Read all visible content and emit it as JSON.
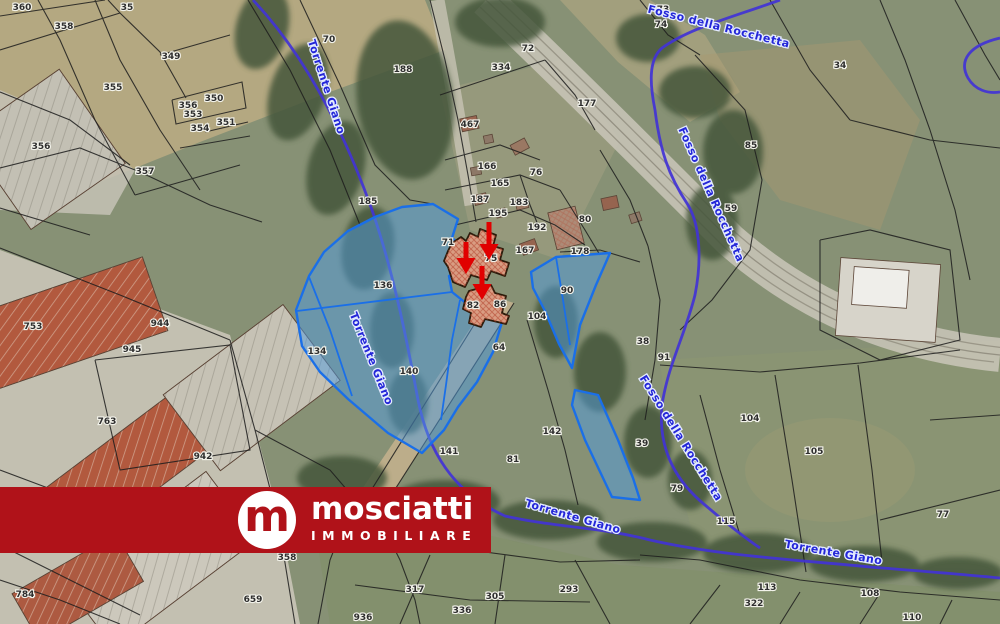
{
  "logo": {
    "monogram": "m",
    "name": "mosciatti",
    "subtitle": "IMMOBILIARE"
  },
  "colors": {
    "banner_red": "#b01219",
    "highlight_fill": "#4f9be0",
    "highlight_stroke": "#1a6fe8",
    "stream_blue": "#4233d6",
    "stream_label_blue": "#2326d8",
    "arrow_red": "#e10000",
    "cadastral_line": "#1d1d1d"
  },
  "map": {
    "parcel_labels": [
      {
        "t": "360",
        "x": 22,
        "y": 10
      },
      {
        "t": "35",
        "x": 127,
        "y": 10
      },
      {
        "t": "358",
        "x": 64,
        "y": 29
      },
      {
        "t": "349",
        "x": 171,
        "y": 59
      },
      {
        "t": "355",
        "x": 113,
        "y": 90
      },
      {
        "t": "356",
        "x": 188,
        "y": 108
      },
      {
        "t": "353",
        "x": 193,
        "y": 117
      },
      {
        "t": "350",
        "x": 214,
        "y": 101
      },
      {
        "t": "354",
        "x": 200,
        "y": 131
      },
      {
        "t": "351",
        "x": 226,
        "y": 125
      },
      {
        "t": "357",
        "x": 145,
        "y": 174
      },
      {
        "t": "356",
        "x": 41,
        "y": 149
      },
      {
        "t": "70",
        "x": 329,
        "y": 42
      },
      {
        "t": "188",
        "x": 403,
        "y": 72
      },
      {
        "t": "185",
        "x": 368,
        "y": 204
      },
      {
        "t": "467",
        "x": 470,
        "y": 127
      },
      {
        "t": "334",
        "x": 501,
        "y": 70
      },
      {
        "t": "72",
        "x": 528,
        "y": 51
      },
      {
        "t": "177",
        "x": 587,
        "y": 106
      },
      {
        "t": "73",
        "x": 663,
        "y": 12
      },
      {
        "t": "74",
        "x": 661,
        "y": 27
      },
      {
        "t": "34",
        "x": 840,
        "y": 68
      },
      {
        "t": "85",
        "x": 751,
        "y": 148
      },
      {
        "t": "59",
        "x": 731,
        "y": 211
      },
      {
        "t": "166",
        "x": 487,
        "y": 169
      },
      {
        "t": "165",
        "x": 500,
        "y": 186
      },
      {
        "t": "187",
        "x": 480,
        "y": 202
      },
      {
        "t": "183",
        "x": 519,
        "y": 205
      },
      {
        "t": "195",
        "x": 498,
        "y": 216
      },
      {
        "t": "76",
        "x": 536,
        "y": 175
      },
      {
        "t": "192",
        "x": 537,
        "y": 230
      },
      {
        "t": "80",
        "x": 585,
        "y": 222
      },
      {
        "t": "178",
        "x": 580,
        "y": 254
      },
      {
        "t": "167",
        "x": 525,
        "y": 253
      },
      {
        "t": "71",
        "x": 448,
        "y": 245
      },
      {
        "t": "75",
        "x": 491,
        "y": 261
      },
      {
        "t": "82",
        "x": 473,
        "y": 308
      },
      {
        "t": "86",
        "x": 500,
        "y": 307
      },
      {
        "t": "90",
        "x": 567,
        "y": 293
      },
      {
        "t": "104",
        "x": 537,
        "y": 319
      },
      {
        "t": "38",
        "x": 643,
        "y": 344
      },
      {
        "t": "91",
        "x": 664,
        "y": 360
      },
      {
        "t": "136",
        "x": 383,
        "y": 288
      },
      {
        "t": "134",
        "x": 317,
        "y": 354
      },
      {
        "t": "140",
        "x": 409,
        "y": 374
      },
      {
        "t": "64",
        "x": 499,
        "y": 350
      },
      {
        "t": "753",
        "x": 33,
        "y": 329
      },
      {
        "t": "944",
        "x": 160,
        "y": 326
      },
      {
        "t": "945",
        "x": 132,
        "y": 352
      },
      {
        "t": "763",
        "x": 107,
        "y": 424
      },
      {
        "t": "942",
        "x": 203,
        "y": 459
      },
      {
        "t": "784",
        "x": 25,
        "y": 597
      },
      {
        "t": "659",
        "x": 253,
        "y": 602
      },
      {
        "t": "358",
        "x": 287,
        "y": 560
      },
      {
        "t": "141",
        "x": 449,
        "y": 454
      },
      {
        "t": "81",
        "x": 513,
        "y": 462
      },
      {
        "t": "142",
        "x": 552,
        "y": 434
      },
      {
        "t": "39",
        "x": 642,
        "y": 446
      },
      {
        "t": "79",
        "x": 677,
        "y": 491
      },
      {
        "t": "317",
        "x": 415,
        "y": 592
      },
      {
        "t": "305",
        "x": 495,
        "y": 599
      },
      {
        "t": "336",
        "x": 462,
        "y": 613
      },
      {
        "t": "293",
        "x": 569,
        "y": 592
      },
      {
        "t": "936",
        "x": 363,
        "y": 620
      },
      {
        "t": "104",
        "x": 750,
        "y": 421
      },
      {
        "t": "105",
        "x": 814,
        "y": 454
      },
      {
        "t": "77",
        "x": 943,
        "y": 517
      },
      {
        "t": "115",
        "x": 726,
        "y": 524
      },
      {
        "t": "113",
        "x": 767,
        "y": 590
      },
      {
        "t": "322",
        "x": 754,
        "y": 606
      },
      {
        "t": "108",
        "x": 870,
        "y": 596
      },
      {
        "t": "110",
        "x": 912,
        "y": 620
      }
    ],
    "stream_labels": [
      {
        "t": "Torrente Giano",
        "x": 323,
        "y": 88,
        "rot": 72
      },
      {
        "t": "Torrente Giano",
        "x": 368,
        "y": 360,
        "rot": 68
      },
      {
        "t": "Fosso della Rocchetta",
        "x": 718,
        "y": 30,
        "rot": 14
      },
      {
        "t": "Fosso della Rocchetta",
        "x": 708,
        "y": 196,
        "rot": 66
      },
      {
        "t": "Fosso della Rocchetta",
        "x": 678,
        "y": 440,
        "rot": 58
      },
      {
        "t": "Torrente Giano",
        "x": 572,
        "y": 520,
        "rot": 16
      },
      {
        "t": "Torrente Giano",
        "x": 833,
        "y": 556,
        "rot": 10
      }
    ],
    "arrows": [
      {
        "x1": 466,
        "y1": 242,
        "x2": 466,
        "y2": 264
      },
      {
        "x1": 489,
        "y1": 222,
        "x2": 489,
        "y2": 250
      },
      {
        "x1": 482,
        "y1": 266,
        "x2": 482,
        "y2": 290
      }
    ]
  }
}
